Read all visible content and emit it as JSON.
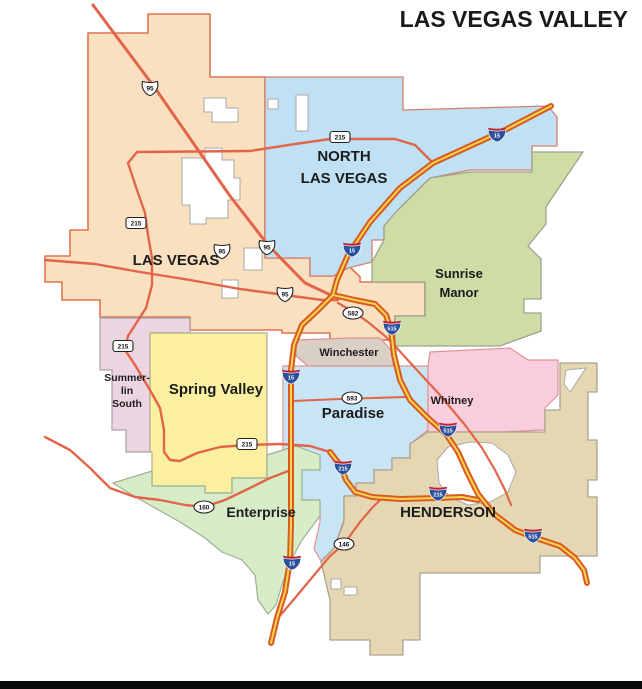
{
  "title": "LAS VEGAS VALLEY",
  "footer": {
    "bar_color": "#0a0a0a"
  },
  "map": {
    "canvas": {
      "width": 642,
      "height": 689,
      "background": "#ffffff"
    },
    "palette": {
      "label_color": "#1c1c1c",
      "highway_color": "#e2654a",
      "interstate_casing": "#d85c22",
      "interstate_core": "#f9d34f",
      "shield_fill": "#ffffff",
      "shield_stroke": "#222222",
      "interstate_blue": "#2a4f9c",
      "interstate_red": "#bf2033",
      "enclave_fill": "#ffffff",
      "enclave_stroke": "#a9a9a9"
    },
    "regions": [
      {
        "id": "las-vegas",
        "name": "Las Vegas",
        "fill": "#f8e0c0",
        "stroke": "#e0744e",
        "stroke_width": 1.6,
        "label": {
          "lines": [
            "LAS VEGAS"
          ],
          "x": 176,
          "y": 265,
          "size": 15,
          "line_height": 20
        },
        "path": "M 88 33 L 148 33 L 148 14 L 210 14 L 210 77 L 265 77 L 265 258 L 310 258 L 310 276 L 333 276 L 346 263 L 360 277 L 360 282 L 425 282 L 425 316 L 395 316 L 395 340 L 330 340 L 330 333 L 282 333 L 282 330 L 190 330 L 190 317 L 100 317 L 100 300 L 62 300 L 62 282 L 45 282 L 45 256 L 70 256 L 70 230 L 88 230 Z"
      },
      {
        "id": "north-las-vegas",
        "name": "North Las Vegas",
        "fill": "#bfe1f3",
        "stroke": "#d4826e",
        "stroke_width": 1.3,
        "label": {
          "lines": [
            "NORTH",
            "LAS VEGAS"
          ],
          "x": 344,
          "y": 161,
          "size": 15,
          "line_height": 22
        },
        "path": "M 265 77 L 403 77 L 403 110 L 548 106 L 557 117 L 557 146 L 532 146 L 532 170 L 470 170 L 430 178 L 396 212 L 384 226 L 384 240 L 372 240 L 372 262 L 348 268 L 333 276 L 310 276 L 310 258 L 265 258 Z"
      },
      {
        "id": "sunrise-manor",
        "name": "Sunrise Manor",
        "fill": "#cedca6",
        "stroke": "#9aa48e",
        "stroke_width": 1.3,
        "label": {
          "lines": [
            "Sunrise",
            "Manor"
          ],
          "x": 459,
          "y": 278,
          "size": 13,
          "line_height": 19
        },
        "path": "M 470 172 L 532 172 L 532 152 L 583 152 L 560 186 L 546 207 L 546 224 L 528 246 L 541 259 L 541 299 L 524 299 L 524 313 L 541 313 L 541 331 L 500 346 L 395 346 L 395 316 L 425 316 L 425 282 L 372 282 L 372 262 L 384 240 L 384 226 L 396 212 L 430 178 Z"
      },
      {
        "id": "winchester",
        "name": "Winchester",
        "fill": "#d9cfc5",
        "stroke": "#e29292",
        "stroke_width": 1.2,
        "label": {
          "lines": [
            "Winchester"
          ],
          "x": 349,
          "y": 356,
          "size": 11,
          "line_height": 13
        },
        "path": "M 296 340 L 352 338 L 380 338 L 393 352 L 393 366 L 308 366 L 296 356 Z"
      },
      {
        "id": "summerlin-south",
        "name": "Summerlin South",
        "fill": "#ecd5e1",
        "stroke": "#a9a0a8",
        "stroke_width": 1.2,
        "label": {
          "lines": [
            "Summer-",
            "lin",
            "South"
          ],
          "x": 127,
          "y": 381,
          "size": 10.5,
          "line_height": 13
        },
        "path": "M 100 318 L 190 318 L 190 333 L 150 333 L 150 452 L 126 452 L 126 430 L 112 430 L 112 370 L 100 370 Z"
      },
      {
        "id": "spring-valley",
        "name": "Spring Valley",
        "fill": "#faf0a0",
        "stroke": "#b0ab8e",
        "stroke_width": 1.2,
        "label": {
          "lines": [
            "Spring Valley"
          ],
          "x": 216,
          "y": 394,
          "size": 15,
          "line_height": 18
        },
        "path": "M 150 333 L 267 333 L 267 478 L 232 478 L 232 493 L 205 493 L 205 486 L 152 486 L 152 452 L 150 452 Z"
      },
      {
        "id": "paradise",
        "name": "Paradise",
        "fill": "#c8e5f6",
        "stroke": "#e29292",
        "stroke_width": 1.2,
        "label": {
          "lines": [
            "Paradise"
          ],
          "x": 353,
          "y": 418,
          "size": 15,
          "line_height": 18
        },
        "path": "M 283 366 L 428 366 L 428 430 L 410 444 L 410 458 L 392 458 L 392 470 L 374 470 L 374 483 L 356 483 L 356 496 L 344 496 L 344 520 L 334 548 L 321 561 L 314 549 L 320 522 L 320 500 L 300 500 L 300 470 L 283 452 Z"
      },
      {
        "id": "whitney",
        "name": "Whitney",
        "fill": "#f8cede",
        "stroke": "#e29292",
        "stroke_width": 1.2,
        "label": {
          "lines": [
            "Whitney"
          ],
          "x": 452,
          "y": 404,
          "size": 11,
          "line_height": 13
        },
        "path": "M 430 352 L 510 348 L 528 360 L 558 360 L 558 395 L 545 408 L 545 430 L 500 432 L 428 432 L 428 366 Z"
      },
      {
        "id": "enterprise",
        "name": "Enterprise",
        "fill": "#d6edc8",
        "stroke": "#9fae96",
        "stroke_width": 1.2,
        "label": {
          "lines": [
            "Enterprise"
          ],
          "x": 261,
          "y": 517,
          "size": 14,
          "line_height": 17
        },
        "path": "M 113 483 L 152 471 L 152 486 L 205 486 L 205 493 L 232 493 L 232 478 L 267 478 L 267 455 L 296 446 L 320 455 L 320 470 L 302 470 L 302 500 L 320 500 L 320 516 L 302 540 L 290 562 L 282 585 L 276 605 L 268 614 L 258 600 L 255 575 L 242 560 L 222 552 L 205 538 L 180 522 L 155 508 L 132 495 Z"
      },
      {
        "id": "henderson",
        "name": "Henderson",
        "fill": "#e4d7b2",
        "stroke": "#aaa390",
        "stroke_width": 1.3,
        "label": {
          "lines": [
            "HENDERSON"
          ],
          "x": 448,
          "y": 517,
          "size": 15,
          "line_height": 18
        },
        "path": "M 428 432 L 545 432 L 545 410 L 560 410 L 560 363 L 597 363 L 597 392 L 588 392 L 588 440 L 597 440 L 597 480 L 588 480 L 588 497 L 597 497 L 597 556 L 540 556 L 540 573 L 420 573 L 420 640 L 403 640 L 403 655 L 370 655 L 370 640 L 330 640 L 330 600 L 321 562 L 334 548 L 344 522 L 344 496 L 356 496 L 356 483 L 374 483 L 374 470 L 392 470 L 392 458 L 410 458 L 410 444 Z"
      }
    ],
    "enclaves": [
      {
        "id": "lv-enclave-big-1",
        "path": "M 182 158 L 205 158 L 205 148 L 222 148 L 222 160 L 234 160 L 234 178 L 240 178 L 240 200 L 228 200 L 228 218 L 206 218 L 206 224 L 190 224 L 190 205 L 182 205 Z"
      },
      {
        "id": "lv-enclave-big-2",
        "path": "M 204 98 L 226 98 L 226 108 L 238 108 L 238 122 L 212 122 L 212 112 L 204 112 Z"
      },
      {
        "id": "lv-enclave-3",
        "path": "M 296 95 L 308 95 L 308 131 L 296 131 Z"
      },
      {
        "id": "lv-enclave-4",
        "path": "M 268 99 L 278 99 L 278 109 L 268 109 Z"
      },
      {
        "id": "lv-enclave-5",
        "path": "M 222 280 L 238 280 L 238 298 L 222 298 Z"
      },
      {
        "id": "lv-enclave-6",
        "path": "M 244 248 L 262 248 L 262 270 L 244 270 Z"
      },
      {
        "id": "sunrise-sliver",
        "path": "M 566 370 L 586 368 L 570 392 L 564 384 Z"
      },
      {
        "id": "henderson-enclave",
        "path": "M 437 460 L 448 447 L 470 442 L 492 443 L 508 455 L 516 472 L 508 492 L 490 502 L 468 505 L 450 497 L 439 483 Z"
      },
      {
        "id": "henderson-small-1",
        "path": "M 331 579 L 341 579 L 341 589 L 331 589 Z"
      },
      {
        "id": "henderson-small-2",
        "path": "M 344 587 L 357 587 L 357 595 L 344 595 Z"
      }
    ],
    "roads": [
      {
        "id": "us95-diagonal",
        "class": "highway",
        "width": 3,
        "path": "M 93 5 L 155 88 L 230 196 L 268 245 L 305 283 L 335 297"
      },
      {
        "id": "us95-west",
        "class": "highway",
        "width": 2.4,
        "path": "M 45 260 L 95 264 L 140 272 L 190 280 L 240 289 L 285 295 L 322 300 L 338 300"
      },
      {
        "id": "cc215-north",
        "class": "highway",
        "width": 2.4,
        "path": "M 433 163 L 415 145 L 395 139 L 330 139 L 295 144 L 250 151 L 137 152"
      },
      {
        "id": "cc215-west-south",
        "class": "highway",
        "width": 2.4,
        "path": "M 137 152 L 128 163 L 137 190 L 145 213 L 148 235 L 152 258 L 152 285 L 146 308 L 128 336 L 125 350 L 135 365 L 150 390 L 160 408 L 164 430 L 164 452 L 170 460 L 180 461 L 197 453 L 220 447 L 246 445 L 280 444 L 310 446 L 330 452"
      },
      {
        "id": "sr160",
        "class": "highway",
        "width": 2.4,
        "path": "M 45 437 L 70 450 L 90 468 L 110 488 L 135 497 L 160 500 L 185 505 L 204 507 L 225 500 L 250 488 L 270 478 L 291 470"
      },
      {
        "id": "sr146",
        "class": "highway",
        "width": 2.2,
        "path": "M 278 618 L 295 598 L 310 580 L 330 556 L 344 544 L 360 522 L 372 508 L 380 500"
      },
      {
        "id": "sr593",
        "class": "highway",
        "width": 2,
        "path": "M 292 401 L 340 399 L 405 397"
      },
      {
        "id": "boulder-hwy-582",
        "class": "highway",
        "width": 2.2,
        "path": "M 338 303 L 352 311 L 368 322 L 385 336 L 395 346 L 415 368 L 440 395 L 465 425 L 482 448 L 495 470 L 505 490 L 511 505"
      },
      {
        "id": "i15",
        "class": "interstate",
        "path": "M 551 106 L 505 130 L 433 163 L 400 188 L 370 222 L 348 255 L 337 280 L 333 295 L 318 310 L 302 325 L 294 345 L 291 370 L 291 470 L 291 525 L 290 560 L 285 592 L 277 618 L 271 643"
      },
      {
        "id": "i515",
        "class": "interstate",
        "path": "M 333 295 L 355 300 L 375 304 L 386 315 L 391 330 L 394 355 L 400 380 L 410 400 L 428 418 L 446 434 L 458 452 L 468 474 L 478 494 L 494 514 L 515 530 L 533 537 L 560 546 L 575 558 L 584 570 L 587 583"
      },
      {
        "id": "i215",
        "class": "interstate",
        "path": "M 330 452 L 340 465 L 346 480 L 355 492 L 372 497 L 400 499 L 438 498 L 462 497 L 478 500"
      }
    ],
    "shields": [
      {
        "kind": "us",
        "label": "95",
        "x": 150,
        "y": 88
      },
      {
        "kind": "us",
        "label": "95",
        "x": 222,
        "y": 251
      },
      {
        "kind": "us",
        "label": "95",
        "x": 267,
        "y": 247
      },
      {
        "kind": "us",
        "label": "95",
        "x": 285,
        "y": 294
      },
      {
        "kind": "rect",
        "label": "215",
        "x": 340,
        "y": 137
      },
      {
        "kind": "rect",
        "label": "215",
        "x": 136,
        "y": 223
      },
      {
        "kind": "rect",
        "label": "215",
        "x": 123,
        "y": 346
      },
      {
        "kind": "rect",
        "label": "215",
        "x": 247,
        "y": 444
      },
      {
        "kind": "oval",
        "label": "582",
        "x": 353,
        "y": 313
      },
      {
        "kind": "oval",
        "label": "593",
        "x": 352,
        "y": 398
      },
      {
        "kind": "oval",
        "label": "160",
        "x": 204,
        "y": 507
      },
      {
        "kind": "oval",
        "label": "146",
        "x": 344,
        "y": 544
      },
      {
        "kind": "interstate",
        "label": "15",
        "x": 497,
        "y": 135
      },
      {
        "kind": "interstate",
        "label": "15",
        "x": 352,
        "y": 250
      },
      {
        "kind": "interstate",
        "label": "15",
        "x": 291,
        "y": 377
      },
      {
        "kind": "interstate",
        "label": "15",
        "x": 292,
        "y": 563
      },
      {
        "kind": "interstate",
        "label": "215",
        "x": 343,
        "y": 468
      },
      {
        "kind": "interstate",
        "label": "215",
        "x": 438,
        "y": 494
      },
      {
        "kind": "interstate",
        "label": "515",
        "x": 392,
        "y": 328
      },
      {
        "kind": "interstate",
        "label": "515",
        "x": 448,
        "y": 430
      },
      {
        "kind": "interstate",
        "label": "515",
        "x": 533,
        "y": 536
      }
    ]
  }
}
